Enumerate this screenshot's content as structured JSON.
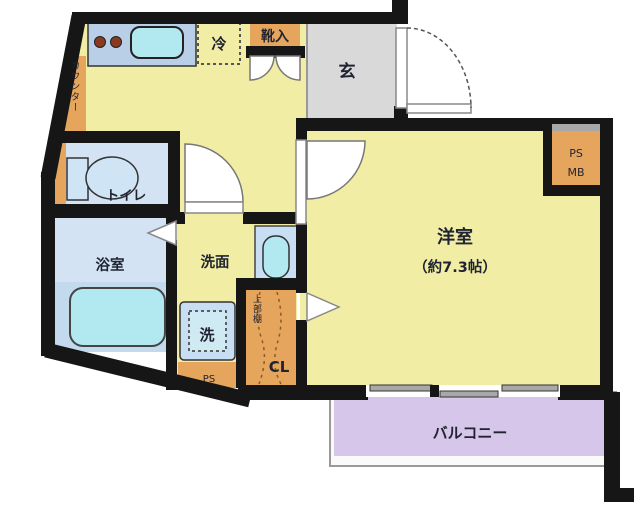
{
  "plan": {
    "type": "floor-plan",
    "rooms": {
      "western_room": {
        "name": "洋室",
        "size": "（約7.3帖）"
      },
      "entrance": {
        "name": "玄"
      },
      "toilet": {
        "name": "トイレ"
      },
      "bathroom": {
        "name": "浴室"
      },
      "washroom": {
        "name": "洗面"
      },
      "balcony": {
        "name": "バルコニー"
      },
      "closet": {
        "name": "CL"
      }
    },
    "labels": {
      "refrigerator": "冷",
      "shoe_box": "靴入",
      "counter": "カウンター",
      "washer": "洗",
      "upper_shelf": "上部棚",
      "pipe_space_bottom": "PS",
      "pipe_space": "PS",
      "meter_box": "MB"
    }
  },
  "colors": {
    "wall": "#161616",
    "room_yellow": "#f2eda4",
    "entry_gray": "#d9d9d9",
    "wet_blue": "#d3e3f3",
    "wet_blue_dark": "#c3d9ee",
    "fixture_cyan": "#b2e8f0",
    "counter_blue": "#b9cfe8",
    "storage_orange": "#e5a55d",
    "balcony_purple": "#d5c6ea",
    "burner_brown": "#8a3a20",
    "window_gray": "#a8a8a8",
    "railing_gray": "#999999"
  }
}
